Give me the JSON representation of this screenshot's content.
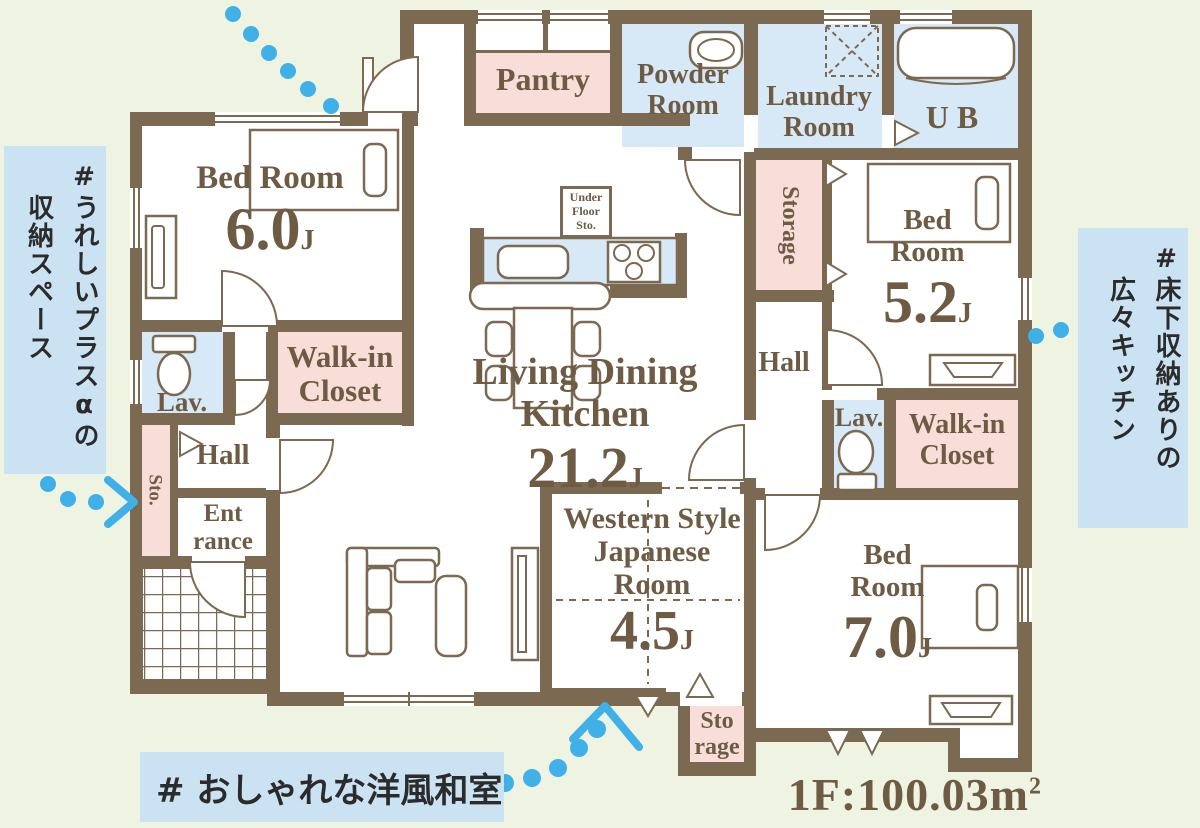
{
  "colors": {
    "background": "#eef3e2",
    "wall_brown": "#7b6951",
    "label_text": "#6d5b44",
    "room_pink": "#f9ddd8",
    "room_blue": "#d7e8f7",
    "annotation_bg": "#cbe2f3",
    "annotation_text": "#2b2b2b",
    "dot_blue": "#3fb1e8"
  },
  "annotations": {
    "left": {
      "line1": "#うれしいプラスαの",
      "line2": "収納スペース"
    },
    "right": {
      "line1": "#床下収納ありの",
      "line2": "広々キッチン"
    },
    "bottom": {
      "text": "# おしゃれな洋風和室"
    }
  },
  "floor_area": {
    "prefix": "1F:100.03m",
    "superscript": "2"
  },
  "rooms": {
    "bedroom_nw": {
      "name": "Bed Room",
      "size": "6.0",
      "unit": "J"
    },
    "bedroom_e": {
      "name": "Bed Room",
      "size": "5.2",
      "unit": "J"
    },
    "bedroom_se": {
      "name": "Bed Room",
      "size": "7.0",
      "unit": "J"
    },
    "ldk": {
      "name": "Living Dining Kitchen",
      "size": "21.2",
      "unit": "J"
    },
    "japanese_room": {
      "name": "Western Style Japanese Room",
      "size": "4.5",
      "unit": "J"
    },
    "pantry": {
      "name": "Pantry"
    },
    "powder_room": {
      "name": "Powder Room"
    },
    "laundry_room": {
      "name": "Laundry Room"
    },
    "unit_bath": {
      "name": "UB"
    },
    "storage_east": {
      "name": "Storage"
    },
    "storage_south": {
      "line1": "Sto",
      "line2": "rage"
    },
    "storage_west": {
      "name": "Sto."
    },
    "hall_west": {
      "name": "Hall"
    },
    "hall_east": {
      "name": "Hall"
    },
    "entrance": {
      "line1": "Ent",
      "line2": "rance"
    },
    "lavatory_west": {
      "name": "Lav."
    },
    "lavatory_east": {
      "name": "Lav."
    },
    "walkin_closet_west": {
      "name": "Walk-in Closet"
    },
    "walkin_closet_east": {
      "name": "Walk-in Closet"
    },
    "underfloor_storage": {
      "line1": "Under",
      "line2": "Floor",
      "line3": "Sto."
    }
  },
  "icons": {
    "bed-icon": "outlined rectangle with pillow",
    "toilet-icon": "tank rectangle + bowl ellipse",
    "bathtub-icon": "rounded rectangle",
    "washing-machine-icon": "dashed square with X",
    "sink-icon": "oval basin",
    "stove-icon": "three burner circles",
    "dining-table-icon": "table with four chairs",
    "sofa-icon": "L-shaped sofa",
    "tv-board-icon": "low board with trapezoid",
    "dresser-icon": "tall cabinet rectangle",
    "door-arc-icon": "quarter-circle door swing",
    "folding-door-icon": "white triangle",
    "vent-icon": "small down triangle",
    "dotted-leader-icon": "blue dot trail",
    "arrow-icon": "blue chevron"
  }
}
